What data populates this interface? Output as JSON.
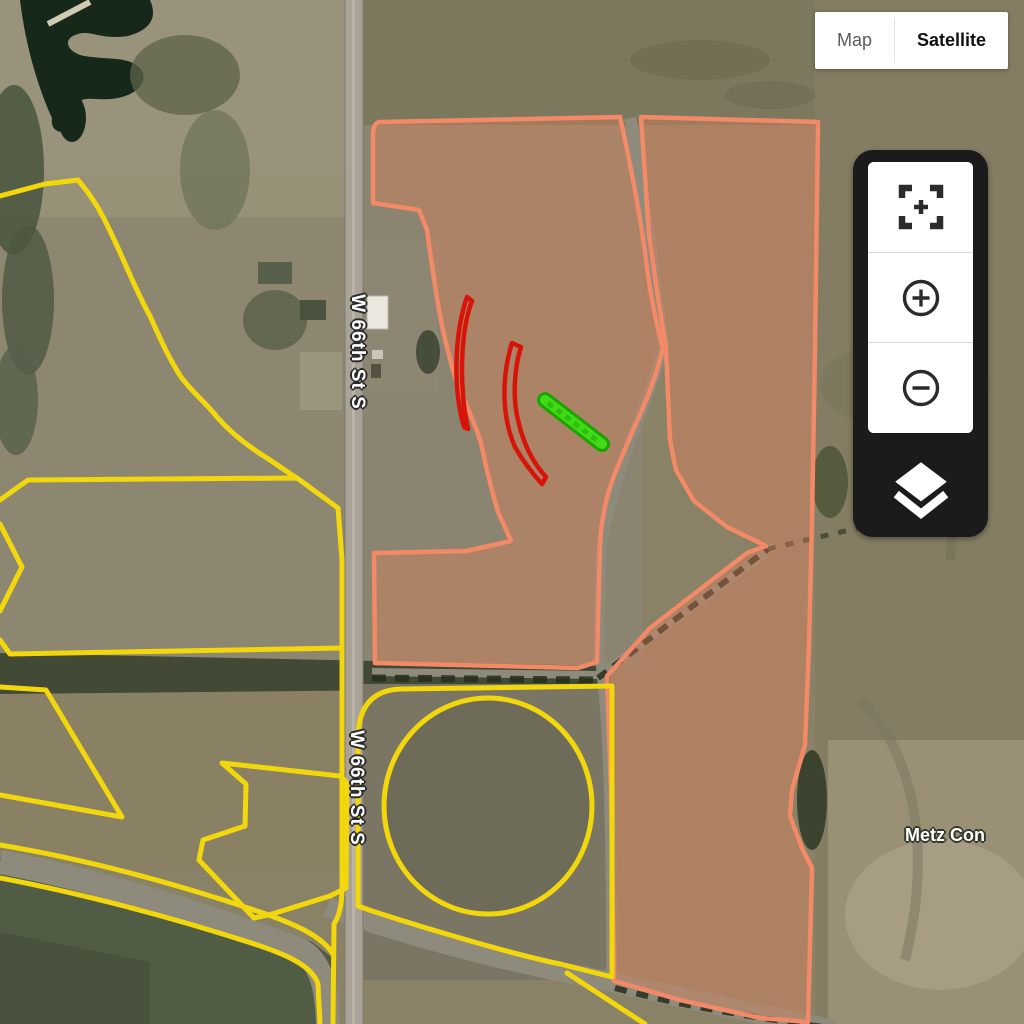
{
  "map_type_control": {
    "map_label": "Map",
    "satellite_label": "Satellite",
    "active": "Satellite"
  },
  "road_labels": {
    "north": "W 66th St S",
    "south": "W 66th St S"
  },
  "place_labels": {
    "bottom_right": "Metz Con"
  },
  "navigation_controls": {
    "icons": [
      "fullscreen-expand-icon",
      "zoom-in-icon",
      "zoom-out-icon",
      "layers-icon"
    ]
  },
  "overlays": {
    "yellow_field_boundaries": 8,
    "salmon_field_polygons": 2,
    "red_annotations": 2,
    "green_annotations": 1
  },
  "overlay_colors": {
    "field_boundary_yellow": "#f2d70c",
    "field_fill_salmon": "rgba(240,128,88,0.34)",
    "field_stroke_salmon": "#f28a68",
    "annotation_red": "#d81408",
    "annotation_green": "#3fdb16"
  },
  "ui_colors": {
    "panel_background": "#1b1b1b",
    "button_background": "#ffffff",
    "icon_color": "#2b2b2b",
    "active_text": "#111111",
    "inactive_text": "#5b5b5b"
  }
}
